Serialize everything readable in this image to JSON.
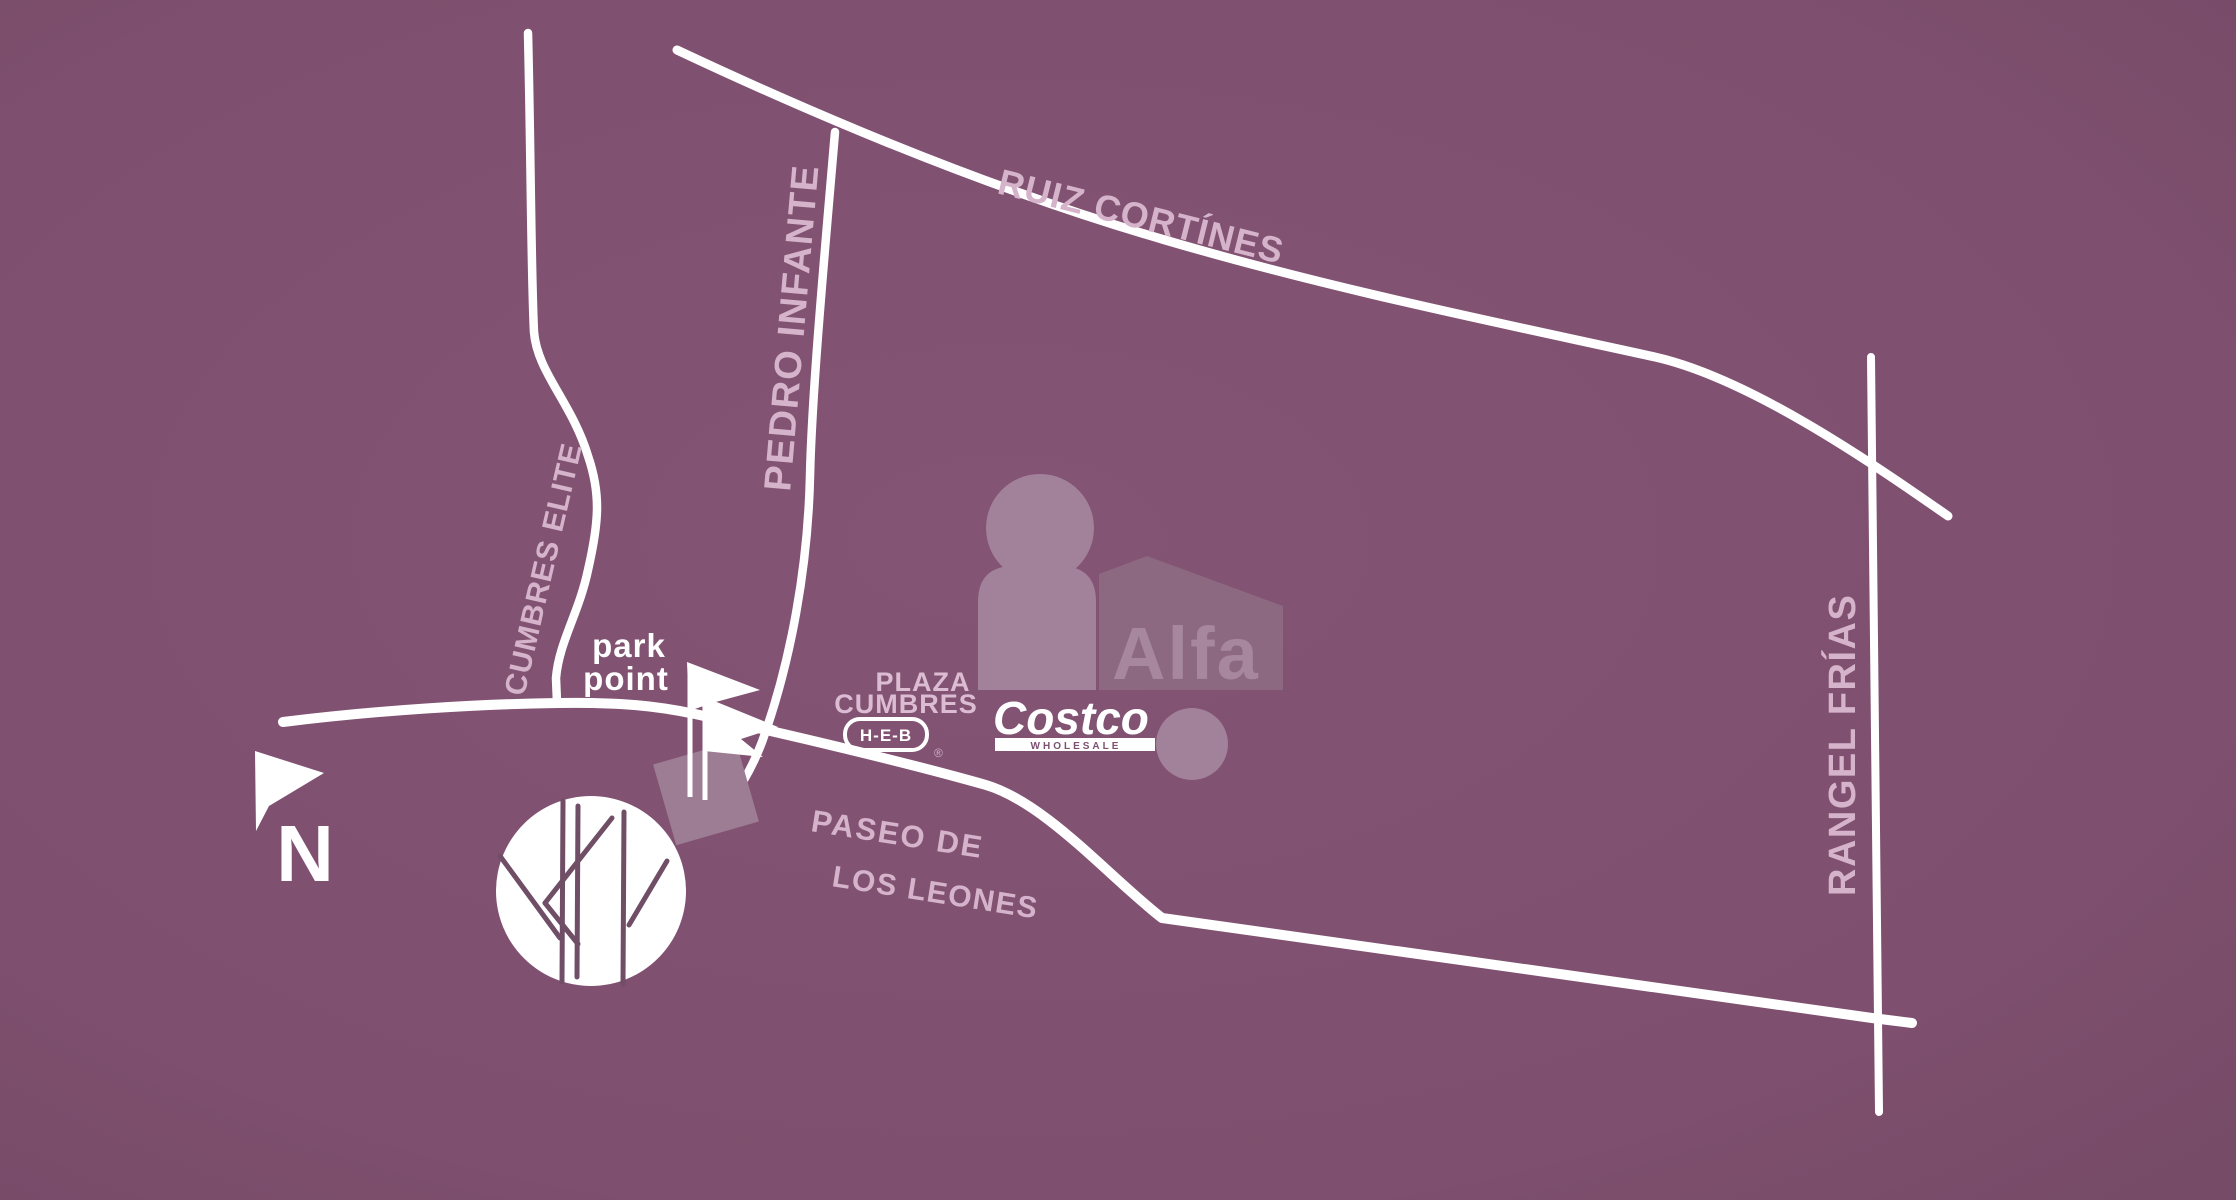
{
  "map": {
    "colors": {
      "background": "#825271",
      "background_edge": "#774b68",
      "road": "#ffffff",
      "street_label": "#d5b3ca",
      "poi_label": "#ffffff",
      "watermark": "#a2819a",
      "watermark_house": "#8c6981",
      "watermark_text": "#a6879d",
      "tree_branch": "#6f4e66",
      "costco_bar_text": "#7c5170"
    },
    "streets": {
      "ruiz_cortines": "RUIZ CORTÍNES",
      "pedro_infante": "PEDRO INFANTE",
      "cumbres_elite": "CUMBRES ELITE",
      "rangel_frias": "RANGEL FRÍAS",
      "paseo_line1": "PASEO DE",
      "paseo_line2": "LOS LEONES"
    },
    "places": {
      "park_point_line1": "park",
      "park_point_line2": "point",
      "plaza_line1": "PLAZA",
      "plaza_line2": "CUMBRES",
      "heb_label": "H-E-B",
      "heb_registered": "®",
      "costco_label": "Costco",
      "costco_sublabel": "WHOLESALE"
    },
    "compass": {
      "north_label": "N"
    },
    "watermark": {
      "brand": "Alfa"
    }
  }
}
